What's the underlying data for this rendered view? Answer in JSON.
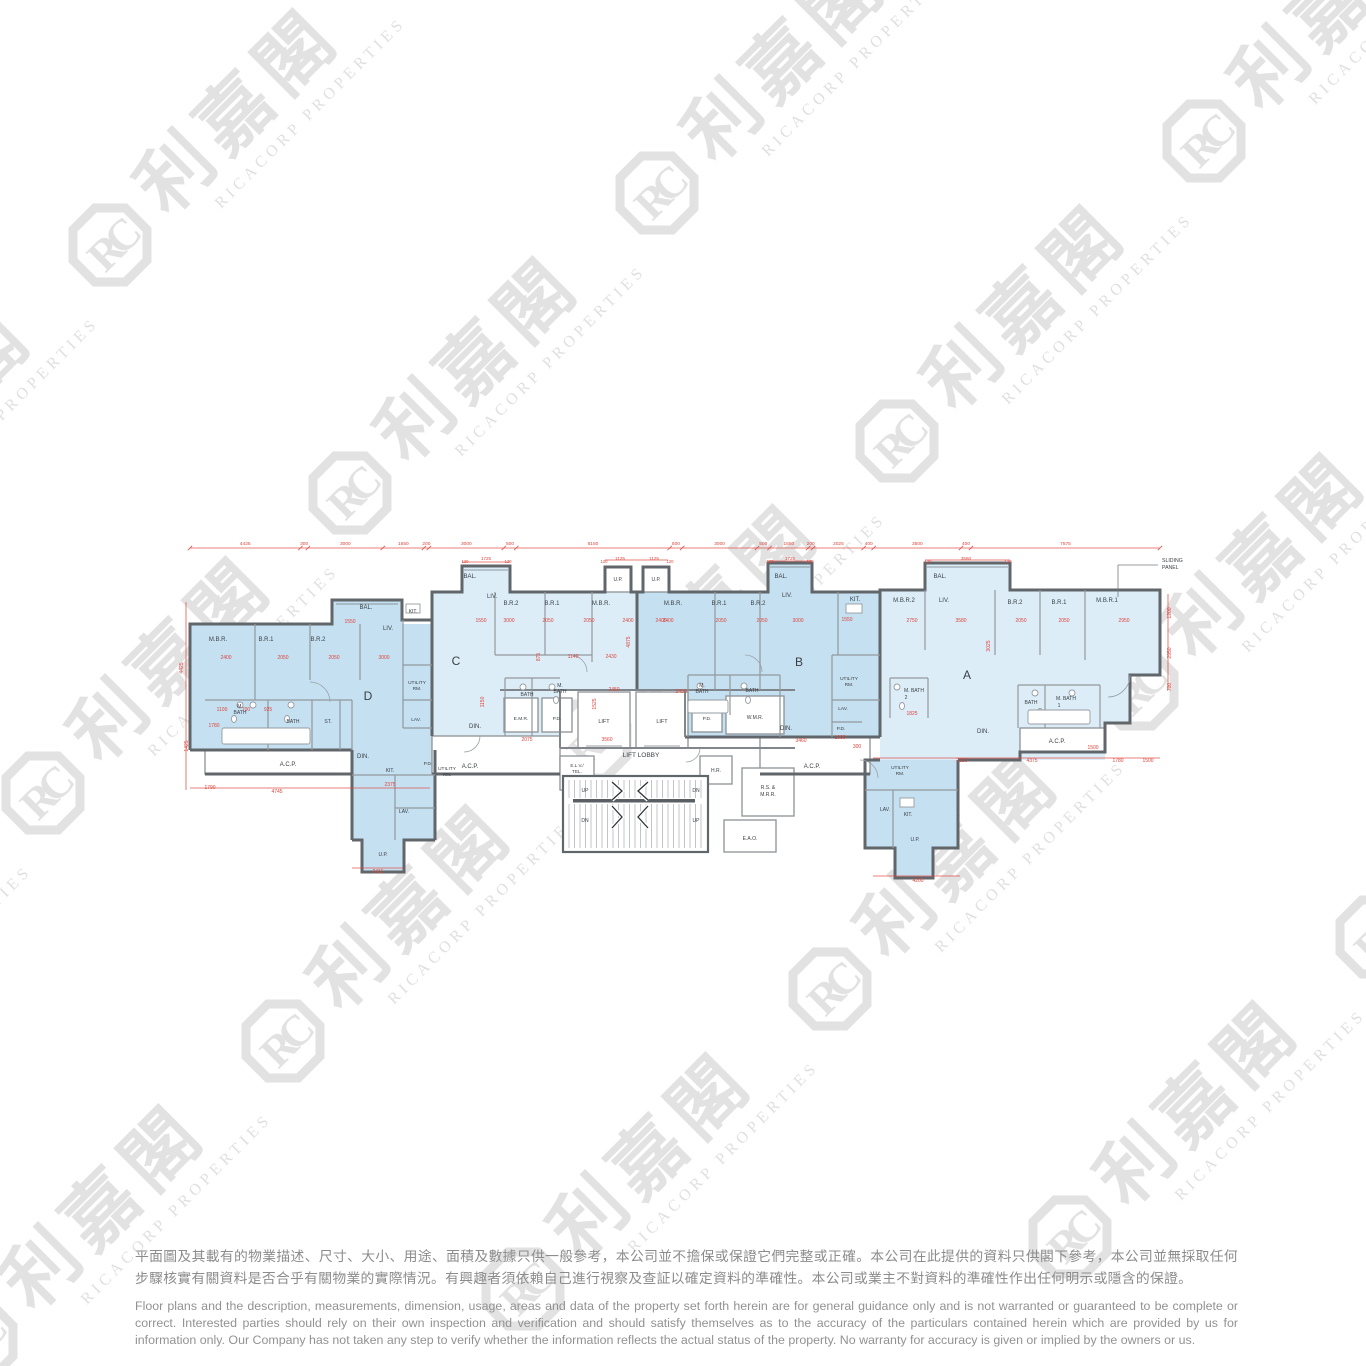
{
  "watermark": {
    "cjk": "利嘉閣",
    "latin": "RICACORP PROPERTIES",
    "logo_text": "RC",
    "color": "#e2e2e2",
    "lattice": {
      "origin": [
        110,
        245
      ],
      "vecA": [
        547,
        -52
      ],
      "vecB": [
        240,
        248
      ],
      "iRange": [
        -2,
        2
      ],
      "jRange": [
        -1,
        4
      ]
    }
  },
  "plan": {
    "colors": {
      "unit_medium": "#c5e0f1",
      "unit_light": "#dcedf8",
      "wall": "#61666b",
      "dimension_red": "#df453c"
    },
    "unit_names": [
      "D",
      "C",
      "B",
      "A"
    ],
    "top_dims": [
      "4425",
      "300",
      "3000",
      "1650",
      "200",
      "3000",
      "500",
      "6150",
      "500",
      "3000",
      "500",
      "1550",
      "200",
      "2025",
      "400",
      "3500",
      "400",
      "7575"
    ],
    "labels": [
      {
        "t": "M.B.R.",
        "x": 218,
        "y": 641
      },
      {
        "t": "B.R.1",
        "x": 266,
        "y": 641
      },
      {
        "t": "B.R.2",
        "x": 318,
        "y": 641
      },
      {
        "t": "BAL.",
        "x": 366,
        "y": 609
      },
      {
        "t": "KIT.",
        "x": 413,
        "y": 613,
        "s": 5
      },
      {
        "t": "LIV.",
        "x": 388,
        "y": 630
      },
      {
        "t": "D",
        "x": 368,
        "y": 700,
        "s": 12
      },
      {
        "t": "UTILITY",
        "x": 417,
        "y": 684,
        "s": 4.8
      },
      {
        "t": "RM.",
        "x": 417,
        "y": 690,
        "s": 4.8
      },
      {
        "t": "LAV.",
        "x": 416,
        "y": 721,
        "s": 4.8
      },
      {
        "t": "M.",
        "x": 240,
        "y": 708,
        "s": 5
      },
      {
        "t": "BATH",
        "x": 240,
        "y": 714,
        "s": 5
      },
      {
        "t": "BATH",
        "x": 293,
        "y": 723,
        "s": 5
      },
      {
        "t": "ST.",
        "x": 328,
        "y": 723,
        "s": 5
      },
      {
        "t": "DIN.",
        "x": 363,
        "y": 758
      },
      {
        "t": "A.C.P.",
        "x": 288,
        "y": 766
      },
      {
        "t": "KIT.",
        "x": 390,
        "y": 772,
        "s": 5
      },
      {
        "t": "P.D.",
        "x": 428,
        "y": 765,
        "s": 4.8
      },
      {
        "t": "UTILITY",
        "x": 447,
        "y": 770,
        "s": 4.8
      },
      {
        "t": "RM.",
        "x": 447,
        "y": 776,
        "s": 4.8
      },
      {
        "t": "LAV.",
        "x": 404,
        "y": 813,
        "s": 5
      },
      {
        "t": "U.P.",
        "x": 383,
        "y": 856,
        "s": 5
      },
      {
        "t": "BAL.",
        "x": 470,
        "y": 578
      },
      {
        "t": "LIV.",
        "x": 492,
        "y": 598
      },
      {
        "t": "B.R.2",
        "x": 511,
        "y": 605
      },
      {
        "t": "B.R.1",
        "x": 552,
        "y": 605
      },
      {
        "t": "M.B.R.",
        "x": 601,
        "y": 605
      },
      {
        "t": "C",
        "x": 456,
        "y": 665,
        "s": 12
      },
      {
        "t": "BATH",
        "x": 527,
        "y": 696,
        "s": 5
      },
      {
        "t": "M.",
        "x": 560,
        "y": 687,
        "s": 5
      },
      {
        "t": "BATH",
        "x": 560,
        "y": 693,
        "s": 5
      },
      {
        "t": "E.M.R.",
        "x": 521,
        "y": 720,
        "s": 4.8
      },
      {
        "t": "P.D.",
        "x": 557,
        "y": 720,
        "s": 4.8
      },
      {
        "t": "DIN.",
        "x": 475,
        "y": 728
      },
      {
        "t": "A.C.P.",
        "x": 470,
        "y": 768
      },
      {
        "t": "U.P.",
        "x": 618,
        "y": 581,
        "s": 5
      },
      {
        "t": "U.P.",
        "x": 656,
        "y": 581,
        "s": 5
      },
      {
        "t": "LIFT",
        "x": 604,
        "y": 723,
        "s": 5.5
      },
      {
        "t": "LIFT",
        "x": 662,
        "y": 723,
        "s": 5.5
      },
      {
        "t": "P.D.",
        "x": 707,
        "y": 720,
        "s": 4.8
      },
      {
        "t": "W.M.R.",
        "x": 755,
        "y": 719,
        "s": 5
      },
      {
        "t": "LIFT LOBBY",
        "x": 641,
        "y": 757,
        "s": 6.5
      },
      {
        "t": "E.L.V./",
        "x": 577,
        "y": 767,
        "s": 4.6
      },
      {
        "t": "TEL.",
        "x": 577,
        "y": 773,
        "s": 4.6
      },
      {
        "t": "H.R.",
        "x": 716,
        "y": 772,
        "s": 5
      },
      {
        "t": "UP",
        "x": 585,
        "y": 792,
        "s": 5
      },
      {
        "t": "DN",
        "x": 696,
        "y": 792,
        "s": 5
      },
      {
        "t": "DN",
        "x": 585,
        "y": 822,
        "s": 5
      },
      {
        "t": "UP",
        "x": 696,
        "y": 822,
        "s": 5
      },
      {
        "t": "R.S. &",
        "x": 768,
        "y": 789,
        "s": 5
      },
      {
        "t": "M.R.R.",
        "x": 768,
        "y": 796,
        "s": 5
      },
      {
        "t": "E.A.O.",
        "x": 750,
        "y": 840,
        "s": 5
      },
      {
        "t": "A.C.P.",
        "x": 812,
        "y": 768
      },
      {
        "t": "M.B.R.",
        "x": 673,
        "y": 605
      },
      {
        "t": "B.R.1",
        "x": 719,
        "y": 605
      },
      {
        "t": "B.R.2",
        "x": 758,
        "y": 605
      },
      {
        "t": "BAL.",
        "x": 781,
        "y": 578
      },
      {
        "t": "LIV.",
        "x": 787,
        "y": 597
      },
      {
        "t": "KIT.",
        "x": 855,
        "y": 601
      },
      {
        "t": "B",
        "x": 799,
        "y": 666,
        "s": 12
      },
      {
        "t": "M.",
        "x": 702,
        "y": 687,
        "s": 5
      },
      {
        "t": "BATH",
        "x": 702,
        "y": 693,
        "s": 5
      },
      {
        "t": "BATH",
        "x": 752,
        "y": 692,
        "s": 5
      },
      {
        "t": "UTILITY",
        "x": 849,
        "y": 680,
        "s": 4.8
      },
      {
        "t": "RM.",
        "x": 849,
        "y": 686,
        "s": 4.8
      },
      {
        "t": "LAV.",
        "x": 843,
        "y": 710,
        "s": 4.8
      },
      {
        "t": "P.D.",
        "x": 841,
        "y": 730,
        "s": 4.8
      },
      {
        "t": "DIN.",
        "x": 786,
        "y": 730
      },
      {
        "t": "M.B.R.2",
        "x": 904,
        "y": 602
      },
      {
        "t": "LIV.",
        "x": 944,
        "y": 602
      },
      {
        "t": "BAL.",
        "x": 940,
        "y": 578
      },
      {
        "t": "B.R.2",
        "x": 1015,
        "y": 604
      },
      {
        "t": "B.R.1",
        "x": 1059,
        "y": 604
      },
      {
        "t": "M.B.R.1",
        "x": 1107,
        "y": 602
      },
      {
        "t": "A",
        "x": 967,
        "y": 679,
        "s": 12
      },
      {
        "t": "M. BATH",
        "x": 914,
        "y": 692,
        "s": 5
      },
      {
        "t": "2",
        "x": 906,
        "y": 699,
        "s": 5
      },
      {
        "t": "BATH",
        "x": 1031,
        "y": 704,
        "s": 5
      },
      {
        "t": "M. BATH",
        "x": 1066,
        "y": 700,
        "s": 5
      },
      {
        "t": "1",
        "x": 1059,
        "y": 707,
        "s": 5
      },
      {
        "t": "DIN.",
        "x": 983,
        "y": 733
      },
      {
        "t": "A.C.P.",
        "x": 1057,
        "y": 743
      },
      {
        "t": "UTILITY",
        "x": 900,
        "y": 769,
        "s": 4.8
      },
      {
        "t": "RM.",
        "x": 900,
        "y": 775,
        "s": 4.8
      },
      {
        "t": "LAV.",
        "x": 885,
        "y": 811,
        "s": 5
      },
      {
        "t": "KIT.",
        "x": 908,
        "y": 816,
        "s": 5
      },
      {
        "t": "U.P.",
        "x": 915,
        "y": 841,
        "s": 5
      },
      {
        "t": "SLIDING",
        "x": 1162,
        "y": 562,
        "s": 5.2,
        "a": "start"
      },
      {
        "t": "PANEL",
        "x": 1162,
        "y": 569,
        "s": 5.2,
        "a": "start"
      }
    ],
    "dims": [
      {
        "v": "4425",
        "x": 183,
        "y": 668,
        "r": true
      },
      {
        "v": "1425",
        "x": 188,
        "y": 746,
        "r": true
      },
      {
        "v": "1780",
        "x": 214,
        "y": 727
      },
      {
        "v": "1790",
        "x": 210,
        "y": 789
      },
      {
        "v": "4745",
        "x": 277,
        "y": 793
      },
      {
        "v": "2375",
        "x": 390,
        "y": 786
      },
      {
        "v": "2415",
        "x": 378,
        "y": 873
      },
      {
        "v": "4200",
        "x": 918,
        "y": 882
      },
      {
        "v": "2400",
        "x": 226,
        "y": 659
      },
      {
        "v": "2050",
        "x": 283,
        "y": 659
      },
      {
        "v": "2050",
        "x": 334,
        "y": 659
      },
      {
        "v": "3000",
        "x": 384,
        "y": 659
      },
      {
        "v": "1550",
        "x": 350,
        "y": 623
      },
      {
        "v": "1100",
        "x": 222,
        "y": 711
      },
      {
        "v": "700",
        "x": 246,
        "y": 711
      },
      {
        "v": "925",
        "x": 268,
        "y": 711
      },
      {
        "v": "1550",
        "x": 481,
        "y": 622
      },
      {
        "v": "3000",
        "x": 509,
        "y": 622
      },
      {
        "v": "2050",
        "x": 548,
        "y": 622
      },
      {
        "v": "2050",
        "x": 589,
        "y": 622
      },
      {
        "v": "2400",
        "x": 628,
        "y": 622
      },
      {
        "v": "2400",
        "x": 668,
        "y": 622
      },
      {
        "v": "1140",
        "x": 573,
        "y": 658
      },
      {
        "v": "2430",
        "x": 611,
        "y": 658
      },
      {
        "v": "875",
        "x": 540,
        "y": 657,
        "r": true
      },
      {
        "v": "4875",
        "x": 630,
        "y": 642,
        "r": true
      },
      {
        "v": "1150",
        "x": 484,
        "y": 702,
        "r": true
      },
      {
        "v": "2450",
        "x": 614,
        "y": 691
      },
      {
        "v": "1525",
        "x": 596,
        "y": 704,
        "r": true
      },
      {
        "v": "2075",
        "x": 527,
        "y": 741
      },
      {
        "v": "3560",
        "x": 607,
        "y": 741
      },
      {
        "v": "120",
        "x": 465,
        "y": 563,
        "s": 4.2
      },
      {
        "v": "1725",
        "x": 486,
        "y": 560,
        "s": 4.6
      },
      {
        "v": "120",
        "x": 508,
        "y": 563,
        "s": 4.2
      },
      {
        "v": "120",
        "x": 604,
        "y": 563,
        "s": 4.2
      },
      {
        "v": "1125",
        "x": 620,
        "y": 560,
        "s": 4.6
      },
      {
        "v": "1125",
        "x": 654,
        "y": 560,
        "s": 4.6
      },
      {
        "v": "120",
        "x": 670,
        "y": 563,
        "s": 4.2
      },
      {
        "v": "120",
        "x": 770,
        "y": 563,
        "s": 4.2
      },
      {
        "v": "1725",
        "x": 790,
        "y": 560,
        "s": 4.6
      },
      {
        "v": "120",
        "x": 810,
        "y": 563,
        "s": 4.2
      },
      {
        "v": "120",
        "x": 928,
        "y": 563,
        "s": 4.2
      },
      {
        "v": "3560",
        "x": 966,
        "y": 560,
        "s": 4.6
      },
      {
        "v": "120",
        "x": 1008,
        "y": 563,
        "s": 4.2
      },
      {
        "v": "2400",
        "x": 661,
        "y": 622
      },
      {
        "v": "2050",
        "x": 721,
        "y": 622
      },
      {
        "v": "2050",
        "x": 762,
        "y": 622
      },
      {
        "v": "3000",
        "x": 798,
        "y": 622
      },
      {
        "v": "1550",
        "x": 847,
        "y": 621
      },
      {
        "v": "2450",
        "x": 681,
        "y": 693
      },
      {
        "v": "3460",
        "x": 801,
        "y": 742
      },
      {
        "v": "1600",
        "x": 840,
        "y": 739
      },
      {
        "v": "300",
        "x": 857,
        "y": 748
      },
      {
        "v": "2750",
        "x": 912,
        "y": 622
      },
      {
        "v": "3580",
        "x": 961,
        "y": 622
      },
      {
        "v": "2050",
        "x": 1021,
        "y": 622
      },
      {
        "v": "2050",
        "x": 1064,
        "y": 622
      },
      {
        "v": "2950",
        "x": 1124,
        "y": 622
      },
      {
        "v": "3025",
        "x": 990,
        "y": 646,
        "r": true
      },
      {
        "v": "1825",
        "x": 912,
        "y": 715
      },
      {
        "v": "2125",
        "x": 962,
        "y": 762
      },
      {
        "v": "4375",
        "x": 1032,
        "y": 762
      },
      {
        "v": "1780",
        "x": 1118,
        "y": 762
      },
      {
        "v": "1500",
        "x": 1148,
        "y": 762
      },
      {
        "v": "1200",
        "x": 1171,
        "y": 613,
        "r": true
      },
      {
        "v": "2950",
        "x": 1171,
        "y": 653,
        "r": true
      },
      {
        "v": "700",
        "x": 1171,
        "y": 687,
        "r": true
      },
      {
        "v": "1500",
        "x": 1093,
        "y": 749
      }
    ]
  },
  "disclaimer": {
    "zh": "平面圖及其載有的物業描述、尺寸、大小、用途、面積及數據只供一般參考，本公司並不擔保或保證它們完整或正確。本公司在此提供的資料只供閣下參考，本公司並無採取任何步驟核實有關資料是否合乎有關物業的實際情況。有興趣者須依賴自己進行視察及查証以確定資料的準確性。本公司或業主不對資料的準確性作出任何明示或隱含的保證。",
    "en": "Floor plans and the description, measurements, dimension, usage, areas and data of the property set forth herein are for general guidance only and is not warranted or guaranteed to be complete or correct.  Interested parties should rely on their own inspection and verification and should satisfy themselves as to the accuracy of the particulars contained herein which are provided by us for information only.  Our Company has not taken any step to verify whether the information reflects the actual status of the property.  No warranty for accuracy is given or implied by the owners or us."
  }
}
